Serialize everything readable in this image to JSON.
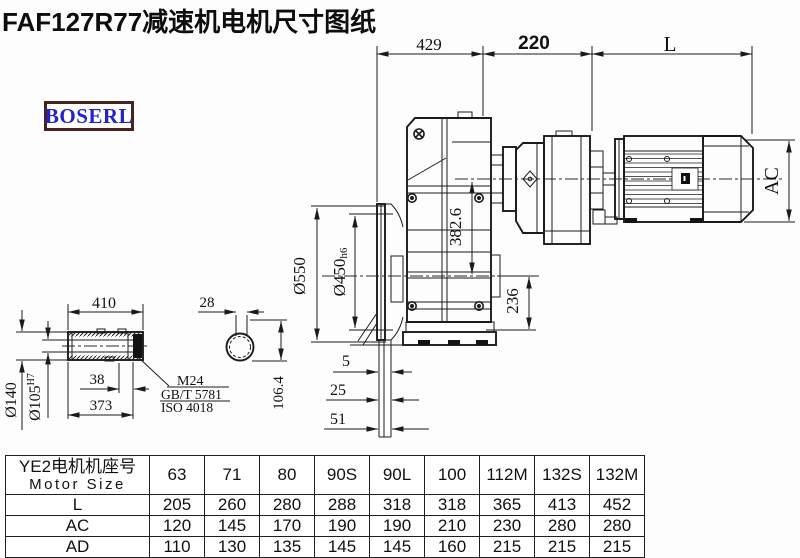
{
  "title": "FAF127R77减速机电机尺寸图纸",
  "brand": "BOSERL",
  "colors": {
    "brand_text": "#2323cc",
    "brand_border": "#46241d",
    "line": "#1b1b1b"
  },
  "drawing": {
    "dims": {
      "top_width_1": "429",
      "top_width_2": "220",
      "motor_length": "L",
      "motor_diameter": "AC",
      "flange_od": "Ø550",
      "flange_pilot": "Ø450",
      "flange_pilot_tol": "h6",
      "center_height": "382.6",
      "base_to_center": "236",
      "fin_a": "5",
      "fin_b": "25",
      "fin_c": "51",
      "shaft_length": "410",
      "shaft_od": "Ø140",
      "bore": "Ø105",
      "bore_tol": "H7",
      "retainer_width": "38",
      "shaft_step": "373",
      "key_width": "28",
      "key_height": "106.4",
      "bolt": "M24",
      "bolt_std_1": "GB/T 5781",
      "bolt_std_2": "ISO 4018"
    }
  },
  "table": {
    "header_cn": "YE2电机机座号",
    "header_en": "Motor Size",
    "columns": [
      "63",
      "71",
      "80",
      "90S",
      "90L",
      "100",
      "112M",
      "132S",
      "132M"
    ],
    "rows": [
      {
        "label": "L",
        "values": [
          "205",
          "260",
          "280",
          "288",
          "318",
          "318",
          "365",
          "413",
          "452"
        ]
      },
      {
        "label": "AC",
        "values": [
          "120",
          "145",
          "170",
          "190",
          "190",
          "210",
          "230",
          "280",
          "280"
        ]
      },
      {
        "label": "AD",
        "values": [
          "110",
          "130",
          "135",
          "145",
          "145",
          "160",
          "215",
          "215",
          "215"
        ]
      }
    ]
  }
}
